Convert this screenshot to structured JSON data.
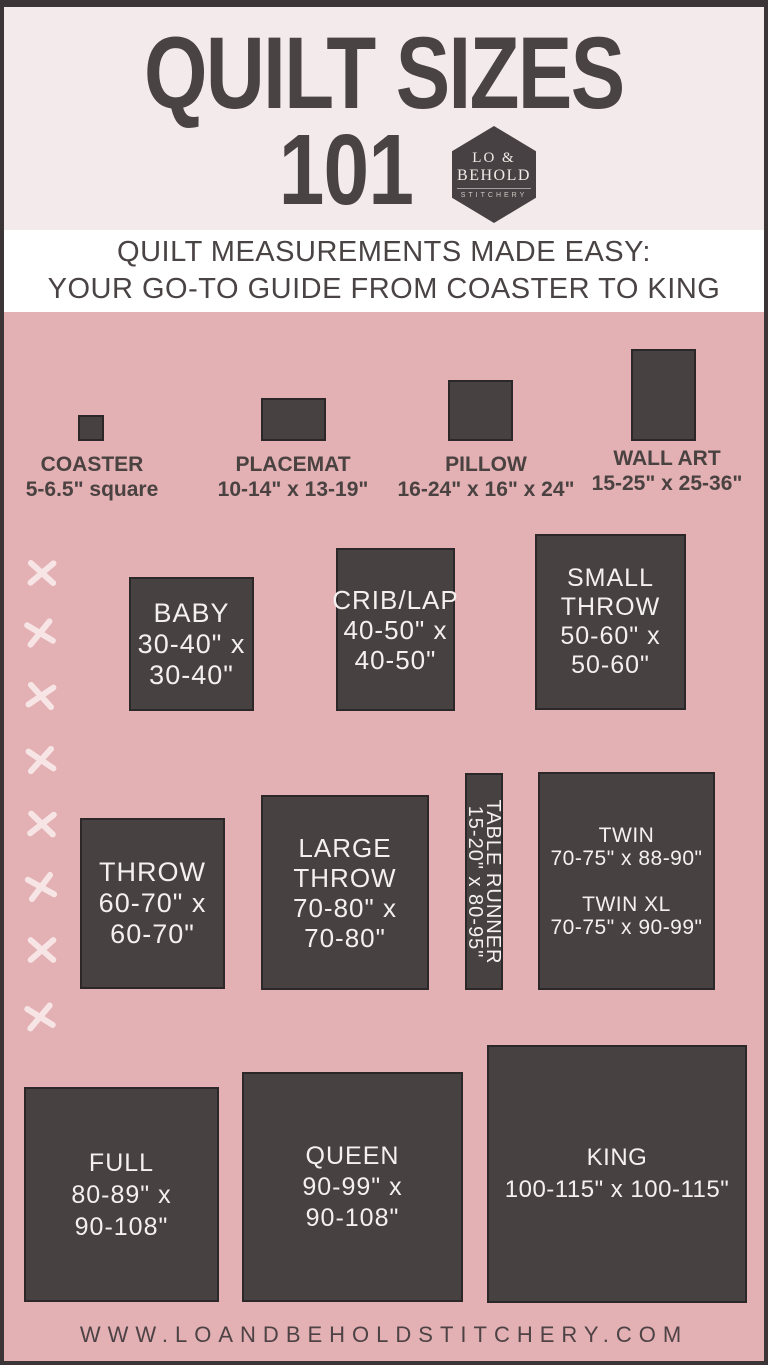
{
  "header": {
    "title_line1": "QUILT SIZES",
    "title_line2": "101"
  },
  "logo": {
    "line1": "LO &",
    "line2": "BEHOLD",
    "line3": "STITCHERY"
  },
  "tagline": {
    "line1": "QUILT MEASUREMENTS MADE EASY:",
    "line2": "YOUR GO-TO GUIDE FROM COASTER TO KING"
  },
  "reference_items": [
    {
      "name": "COASTER",
      "size": "5-6.5\" square"
    },
    {
      "name": "PLACEMAT",
      "size": "10-14\" x 13-19\""
    },
    {
      "name": "PILLOW",
      "size": "16-24\" x 16\" x 24\""
    },
    {
      "name": "WALL ART",
      "size": "15-25\" x 25-36\""
    }
  ],
  "quilts": {
    "baby": {
      "lines": [
        "BABY",
        "30-40\" x",
        "30-40\""
      ]
    },
    "crib_lap": {
      "lines": [
        "CRIB/LAP",
        "40-50\" x",
        "40-50\""
      ]
    },
    "small_throw": {
      "lines": [
        "SMALL",
        "THROW",
        "50-60\" x",
        "50-60\""
      ]
    },
    "throw": {
      "lines": [
        "THROW",
        "60-70\" x",
        "60-70\""
      ]
    },
    "large_throw": {
      "lines": [
        "LARGE",
        "THROW",
        "70-80\" x",
        "70-80\""
      ]
    },
    "table_runner": {
      "lines": [
        "TABLE RUNNER",
        "15-20\" x 80-95\""
      ]
    },
    "twin": {
      "lines": [
        "TWIN",
        "70-75\" x 88-90\"",
        "",
        "TWIN XL",
        "70-75\" x 90-99\""
      ]
    },
    "full": {
      "lines": [
        "FULL",
        "80-89\" x",
        "90-108\""
      ]
    },
    "queen": {
      "lines": [
        "QUEEN",
        "90-99\" x",
        "90-108\""
      ]
    },
    "king": {
      "lines": [
        "KING",
        "100-115\" x 100-115\""
      ]
    }
  },
  "footer": {
    "website": "WWW.LOANDBEHOLDSTITCHERY.COM"
  },
  "colors": {
    "background_pink": "#e3b0b4",
    "header_cream": "#f3eaeb",
    "band_white": "#ffffff",
    "panel_dark": "#474142",
    "frame_border": "#3b3537",
    "stitch_cross": "#f7e5e6",
    "text_dark": "#4a4344",
    "text_light": "#f4f0ed"
  }
}
